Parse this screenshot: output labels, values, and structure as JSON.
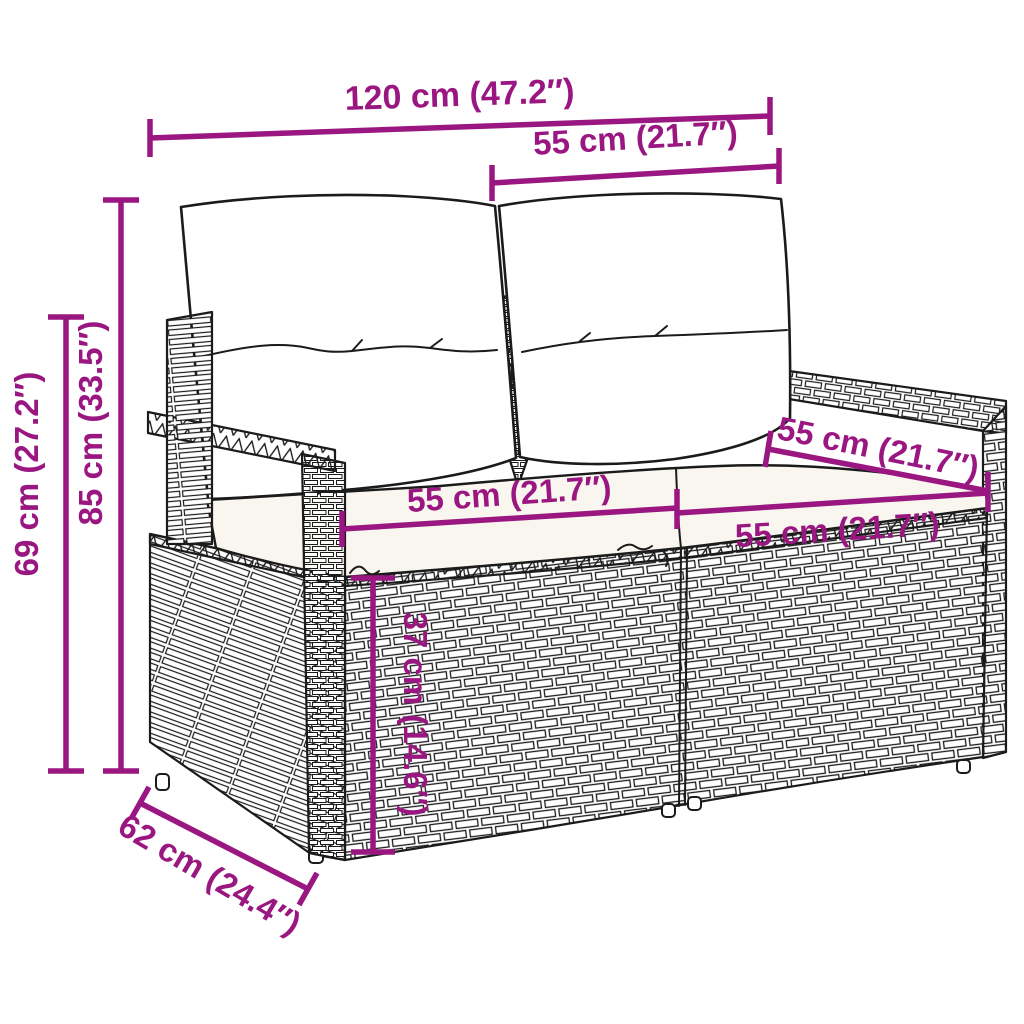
{
  "colors": {
    "accent": "#9A1782",
    "outline": "#1B1B1B",
    "seat_cushion": "#F8F6EE",
    "background": "#FFFFFF"
  },
  "dimensions": {
    "total_width": {
      "label": "120 cm (47.2″)"
    },
    "back_section_width": {
      "label": "55 cm (21.7″)"
    },
    "total_height": {
      "label": "85 cm (33.5″)"
    },
    "arm_height": {
      "label": "69 cm (27.2″)"
    },
    "seat_width_left": {
      "label": "55 cm (21.7″)"
    },
    "seat_width_right": {
      "label": "55 cm (21.7″)"
    },
    "seat_depth": {
      "label": "55 cm (21.7″)"
    },
    "seat_height": {
      "label": "37 cm (14.6″)"
    },
    "total_depth": {
      "label": "62 cm (24.4″)"
    }
  }
}
